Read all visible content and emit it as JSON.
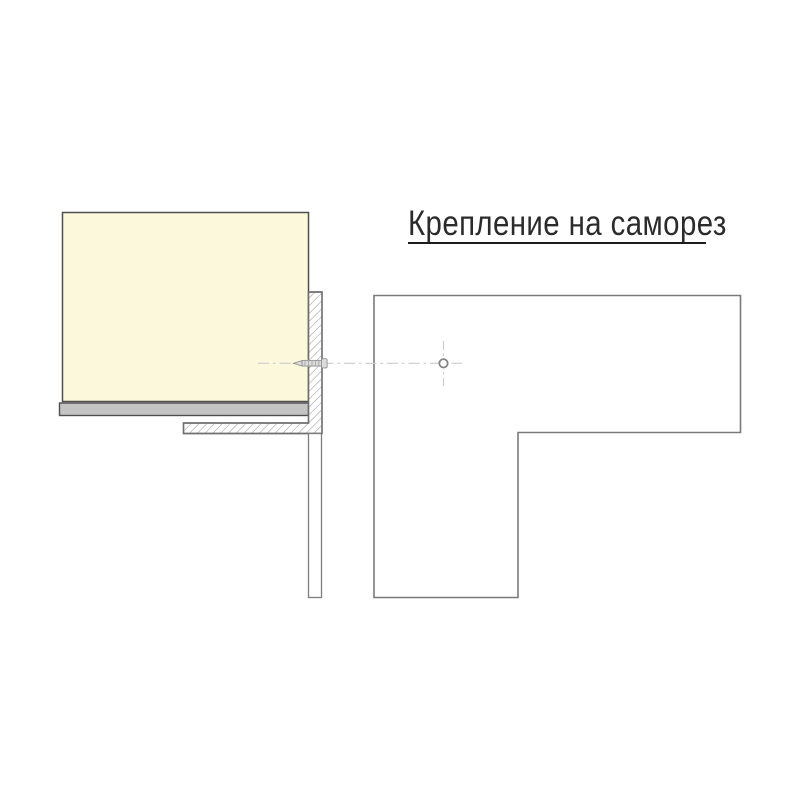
{
  "title": {
    "text": "Крепление на саморез",
    "underlined": true
  },
  "colors": {
    "background": "#ffffff",
    "panel_fill": "#fcf8db",
    "panel_border": "#4f4f4f",
    "edge_strip_fill": "#c4c4c4",
    "edge_strip_border": "#4f4f4f",
    "hatch_line": "#9c9c9c",
    "hatch_border": "#6f6f6f",
    "strip_outline": "#7d7d7d",
    "plan_outline": "#7a7a7a",
    "centerline": "#cccccc",
    "screw_fill": "#dcdcdc",
    "screw_outline": "#909090",
    "screw_thread": "#a8a8a8",
    "hole_stroke": "#858585",
    "white": "#ffffff",
    "title_color": "#2b2b2b",
    "underline_color": "#1c1c1c"
  }
}
